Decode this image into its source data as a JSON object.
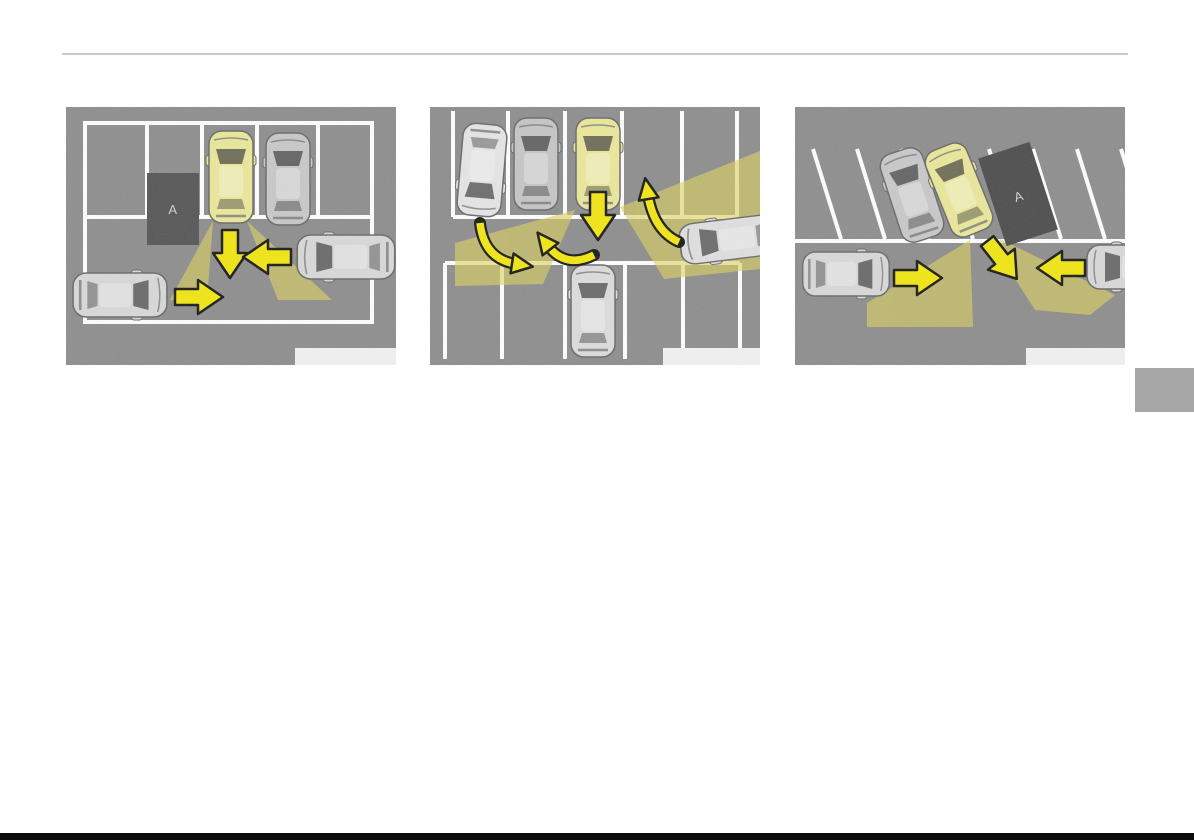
{
  "page": {
    "background_color": "#ffffff",
    "top_rule_color": "#c8c8c8",
    "side_tab_color": "#a6a6a6",
    "bottom_strip_color": "#0d0d0d"
  },
  "colors": {
    "lot_background": "#8e8e8e",
    "lane_marking": "#ffffff",
    "subject_vehicle": "#ebe89a",
    "other_vehicle": "#d9d9d9",
    "obstacle_fill": "#545454",
    "obstacle_label_text": "#d0d0d0",
    "arrow_fill": "#f2e712",
    "arrow_outline": "#1a1a1a",
    "detection_zone": "#ded35f",
    "caption_box": "#f2f2f2"
  },
  "figures": [
    {
      "obstacle_label": "A",
      "caption": ""
    },
    {
      "caption": ""
    },
    {
      "obstacle_label": "A",
      "caption": ""
    }
  ]
}
